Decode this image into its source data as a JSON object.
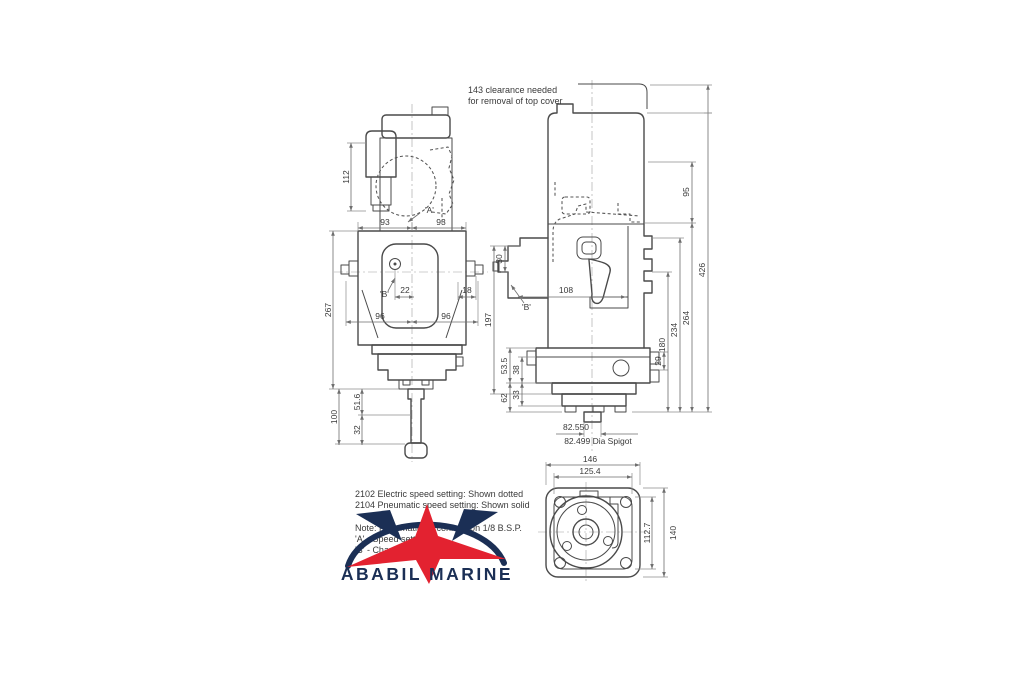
{
  "clearance_note": {
    "line1": "143 clearance needed",
    "line2": "for removal of top cover"
  },
  "front_view": {
    "labels": {
      "d112": "112",
      "d93_left": "93",
      "d93_right": "93",
      "d267": "267",
      "d22": "22",
      "d18": "18",
      "d96_left": "96",
      "d96_right": "96",
      "d51_6": "51.6",
      "d100": "100",
      "d32": "32",
      "ref_a": "'A'",
      "ref_b": "'B'"
    }
  },
  "side_view": {
    "labels": {
      "d95": "95",
      "d426": "426",
      "d264": "264",
      "d234": "234",
      "d180": "180",
      "d29": "29",
      "d30": "30",
      "d108": "108",
      "d197": "197",
      "d53_5": "53.5",
      "d38": "38",
      "d62": "62",
      "d33": "33",
      "spigot_upper": "82.550",
      "spigot_lower": "82.499 Dia Spigot",
      "ref_b": "'B'"
    }
  },
  "bottom_view": {
    "labels": {
      "d146": "146",
      "d125_4": "125.4",
      "d112_7": "112.7",
      "d140": "140"
    }
  },
  "notes": {
    "line1": "2102 Electric speed setting: Shown dotted",
    "line2": "2104 Pneumatic speed setting: Shown solid",
    "line3": "Note: Pneumatic air connection 1/8 B.S.P.",
    "line4": "'A' - Speed setting",
    "line5": "'B' - Charge pressure"
  },
  "watermark": {
    "brand": "ABABIL MARINE"
  },
  "colors": {
    "line": "#4a4a4a",
    "dim": "#6e6e6e",
    "brand_navy": "#1b2f55",
    "brand_red": "#e32230",
    "background": "#ffffff"
  }
}
